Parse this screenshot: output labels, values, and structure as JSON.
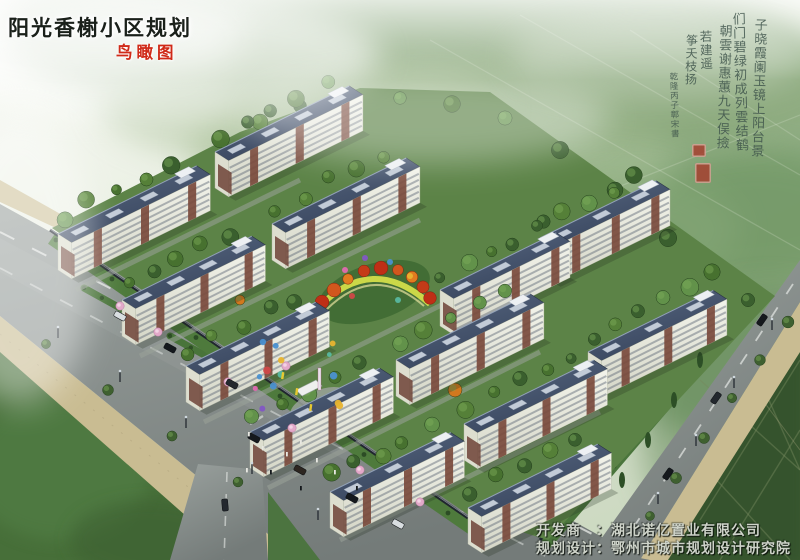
{
  "title": {
    "text": "阳光香榭小区规划"
  },
  "subtitle": {
    "text": "鸟瞰图"
  },
  "calligraphy": {
    "columns": [
      "子晓霞阑玉镜上阳台景",
      "们门碧绿初成列雲结鹤",
      "朝雲谢惠蕙九天俣撿",
      "若建遥",
      "筝夭枝扬",
      "乾隆丙子鄣宋書"
    ],
    "seal_count": 2
  },
  "credits": {
    "line1": "开发商　：湖北诺亿置业有限公司",
    "line2": "规划设计：鄂州市城市规划设计研究院"
  },
  "palette": {
    "title_color": "#1a201a",
    "subtitle_color": "#d02a18",
    "ink_color": "#3d524a",
    "seal_color": "#a83a2c",
    "credits_color": "#ced3c9",
    "roof": "#3e4d63",
    "facade": "#ecede4",
    "accent_brick": "#7a4a3c",
    "lawn": "#5c8347",
    "tree_dark": "#3a5f2e",
    "road": "#848b89",
    "sidewalk": "#c9bc92",
    "field": "#3a5a31",
    "blossom": "#e3a9c9",
    "autumn": "#c8431c",
    "mist": "#f4f7f0"
  }
}
